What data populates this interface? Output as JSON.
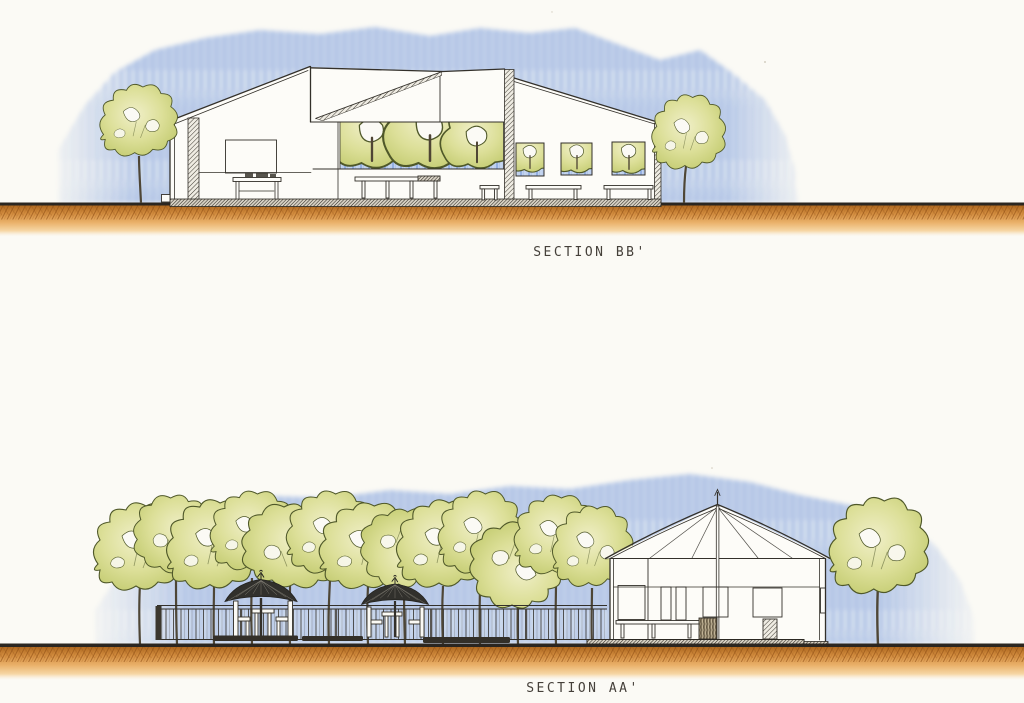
{
  "document": {
    "type_label": "hand-drawn architectural sections",
    "panels": {
      "top": {
        "caption": "SECTION BB'"
      },
      "bottom": {
        "caption": "SECTION AA'"
      }
    }
  },
  "colors": {
    "paper": "#fbfaf5",
    "ink": "#33302a",
    "sky_blue": "#5b85d0",
    "sky_blue_light": "#cfdcf2",
    "foliage_green": "#c3cb70",
    "foliage_light": "#f0efc8",
    "foliage_outline": "#4f5829",
    "trunk_brown": "#4e4636",
    "ground_line": "#2b2620",
    "ground_orange": "#d28c3e",
    "ground_orange_dark": "#8d4d14",
    "umbrella_dark": "#31302c",
    "bench_dark": "#332f28"
  }
}
